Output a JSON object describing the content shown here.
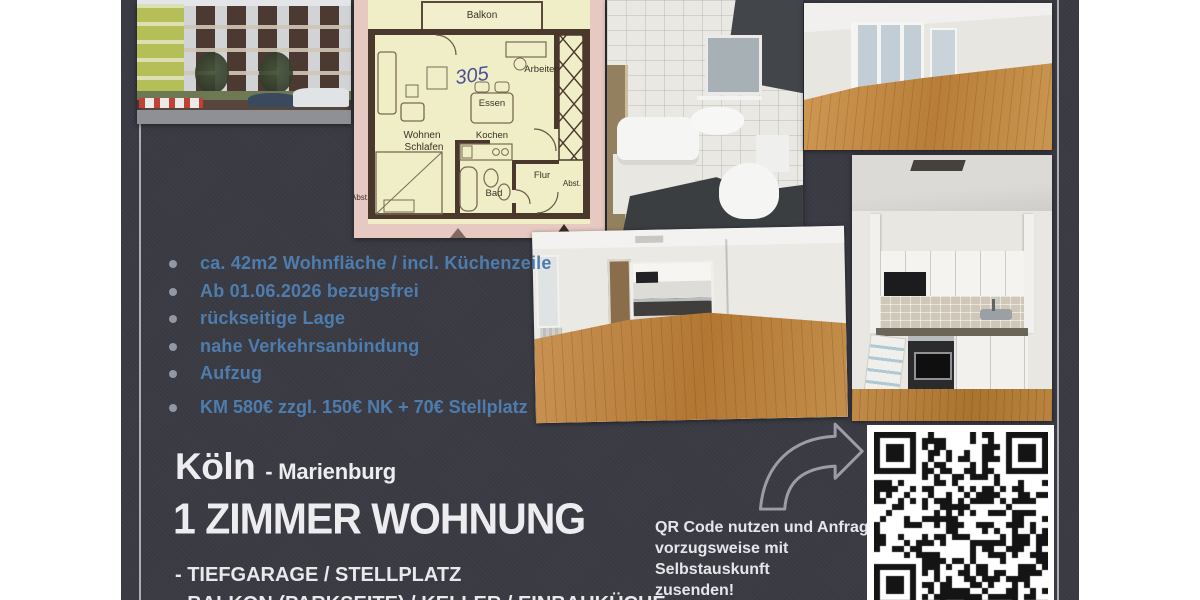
{
  "poster": {
    "colors": {
      "background": "#3b3b45",
      "accent_blue": "#4e7dad",
      "text": "#ededf0"
    },
    "bullets": [
      "ca. 42m2 Wohnfläche / incl. Küchenzeile",
      "Ab 01.06.2026 bezugsfrei",
      "rückseitige Lage",
      "nahe Verkehrsanbindung",
      "Aufzug"
    ],
    "price_line": "KM 580€ zzgl. 150€ NK + 70€ Stellplatz",
    "city": "Köln",
    "district": "- Marienburg",
    "headline": "1 ZIMMER WOHNUNG",
    "features": [
      "- TIEFGARAGE / STELLPLATZ",
      "- BALKON (PARKSEITE) / KELLER / EINBAUKÜCHE"
    ],
    "qr_note": [
      "QR Code nutzen und Anfrage",
      "vorzugsweise mit Selbstauskunft",
      "zusenden!"
    ]
  },
  "floor_plan": {
    "unit_number": "305",
    "labels": {
      "balkon": "Balkon",
      "arbeiten": "Arbeiten",
      "essen": "Essen",
      "wohnen": "Wohnen",
      "schlafen": "Schlafen",
      "kochen": "Kochen",
      "bad": "Bad",
      "flur": "Flur",
      "abst_right": "Abst.",
      "abst_left": "Abst."
    }
  }
}
